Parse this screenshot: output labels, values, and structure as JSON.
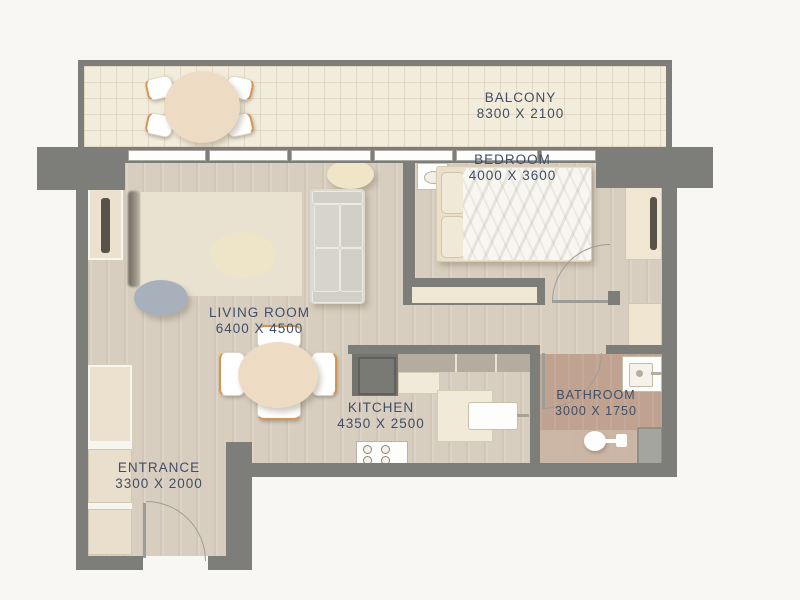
{
  "colors": {
    "bg": "#f8f7f3",
    "wall": "#7d7d79",
    "wall-light": "#9d9d97",
    "wood": "#d8cec0",
    "tile": "#f2ecdc",
    "bath": "#c0a290",
    "bath-light": "#cdb9a9",
    "cream": "#eedbc4",
    "cabinet": "#ebe1ce",
    "navy": "#414e66",
    "orange": "#d8934e",
    "sofa": "#dcd9d2",
    "pouf": "#a8b1bb",
    "white": "#fdfdfb"
  },
  "rooms": [
    {
      "name": "BALCONY",
      "dimensions": "8300 X 2100"
    },
    {
      "name": "BEDROOM",
      "dimensions": "4000 X 3600"
    },
    {
      "name": "LIVING ROOM",
      "dimensions": "6400 X 4500"
    },
    {
      "name": "KITCHEN",
      "dimensions": "4350 X 2500"
    },
    {
      "name": "BATHROOM",
      "dimensions": "3000 X 1750"
    },
    {
      "name": "ENTRANCE",
      "dimensions": "3300 X 2000"
    }
  ],
  "furniture_icons": [
    "outdoor-dining-set",
    "tv-panel",
    "rug",
    "ottoman",
    "coffee-table",
    "sofa",
    "double-bed",
    "bedside-dresser",
    "wardrobe",
    "dining-table-with-chairs",
    "fridge",
    "kitchen-counter",
    "kitchen-sink",
    "stove",
    "linen-closet",
    "bathroom-sink",
    "toilet",
    "shower-tray",
    "entrance-closets"
  ]
}
